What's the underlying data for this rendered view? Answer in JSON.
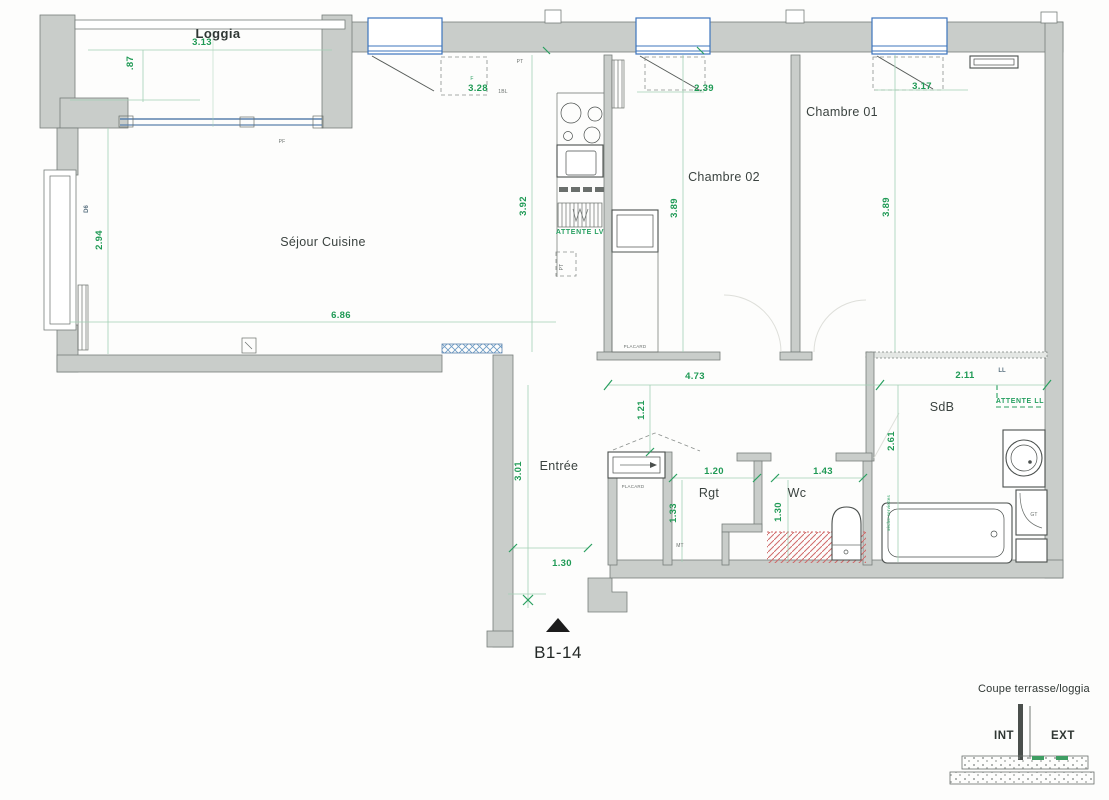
{
  "plan": {
    "id_label": "B1-14",
    "rooms": [
      "Loggia",
      "Séjour Cuisine",
      "Chambre 02",
      "Chambre 01",
      "Entrée",
      "Rgt",
      "Wc",
      "SdB"
    ],
    "dims": [
      "3.13",
      ".87",
      "3.28",
      "2.39",
      "3.17",
      "3.92",
      "3.89",
      "3.89",
      "2.94",
      "6.86",
      "4.73",
      "2.11",
      "1.21",
      "3.01",
      "1.20",
      "1.43",
      "1.33",
      "1.30",
      "2.61",
      "1.30"
    ],
    "notes": {
      "attente_lv": "ATTENTE LV",
      "attente_ll": "ATTENTE LL",
      "placard": "PLACARD",
      "ll": "LL",
      "gt": "GT",
      "pf": "PF",
      "pt": "PT",
      "d6": "D6",
      "f": "F",
      "bl": "1BL",
      "mt": "MT",
      "seche": "sèche-serviettes"
    },
    "detail": {
      "title": "Coupe terrasse/loggia",
      "int": "INT",
      "ext": "EXT"
    }
  },
  "colors": {
    "wall_gray": "#c9cdca",
    "dim_green": "#1f9a55",
    "window_blue": "#3c74bd",
    "hatch_red": "#d06a6a"
  }
}
